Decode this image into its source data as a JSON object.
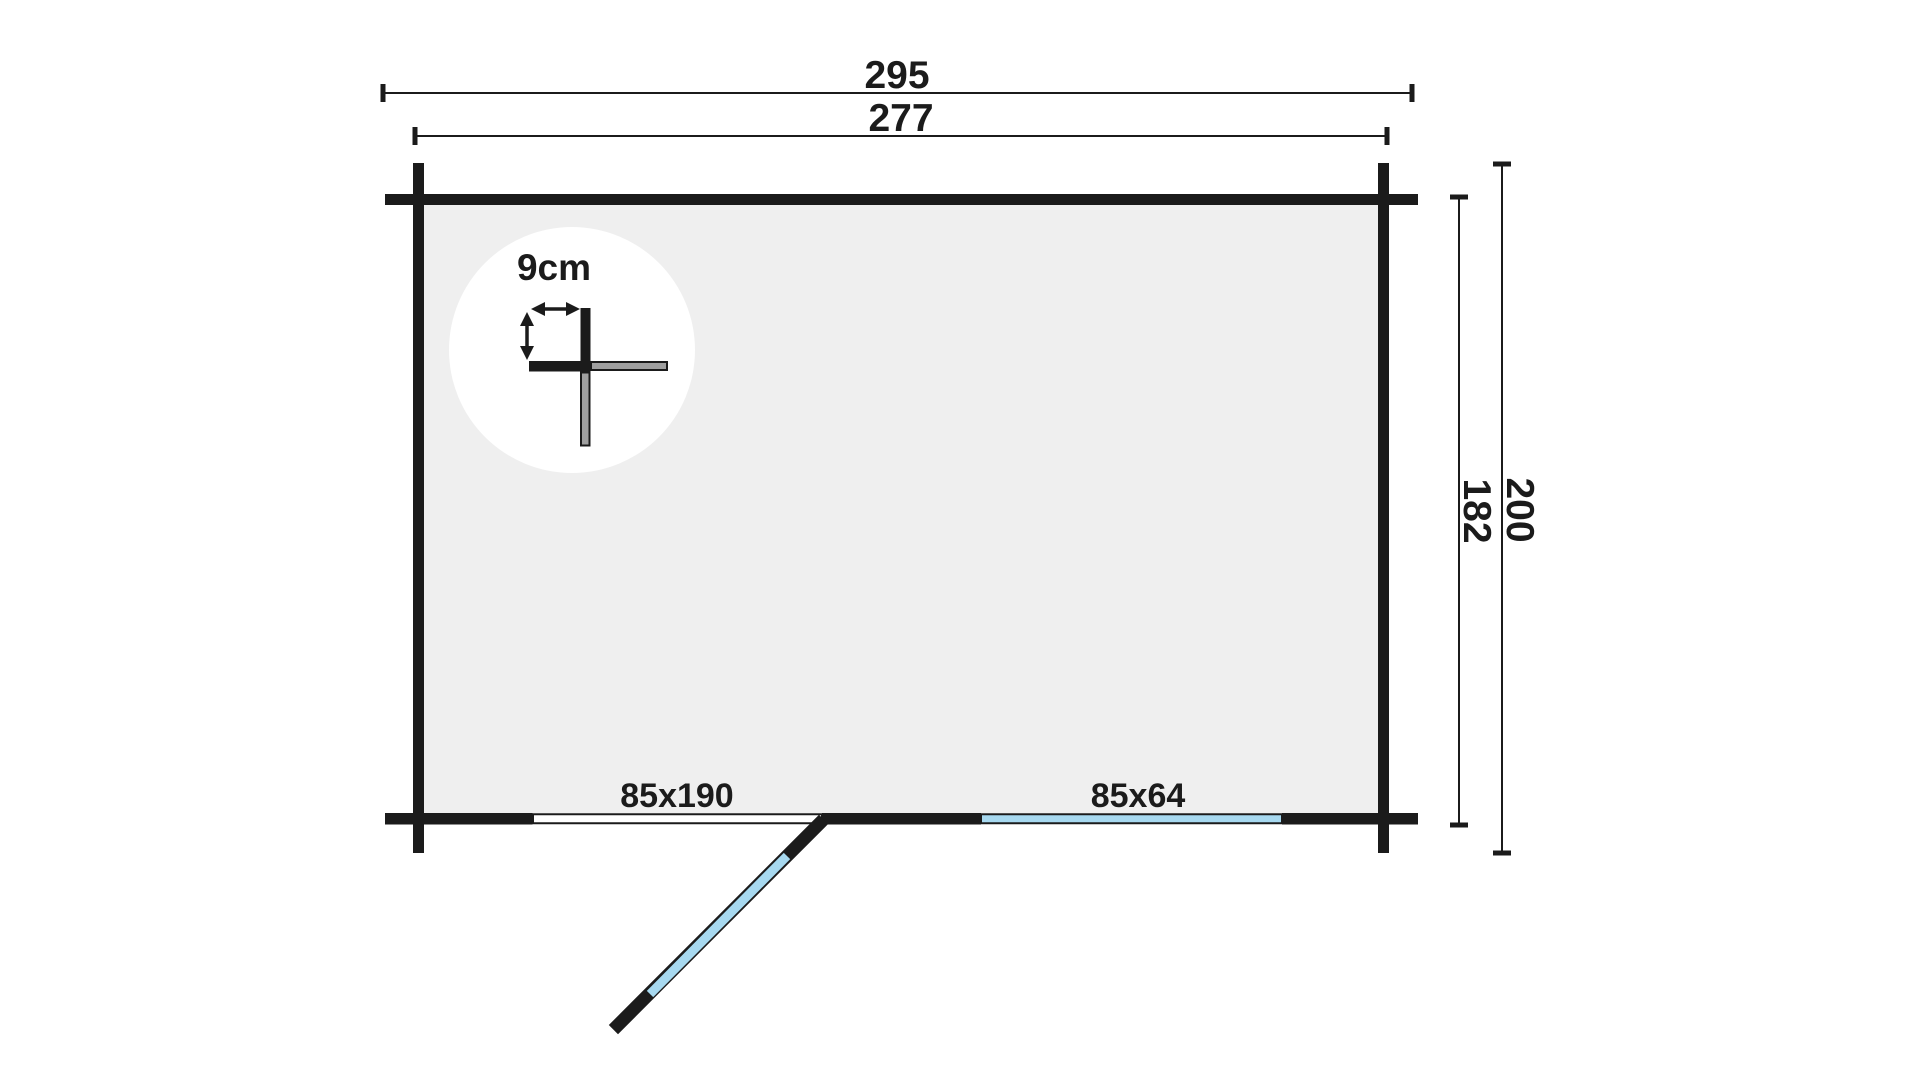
{
  "drawing": {
    "dimensions": {
      "overall_width": "295",
      "wall_to_wall_width": "277",
      "wall_to_wall_depth": "182",
      "overall_depth": "200",
      "wall_thickness": "9cm"
    },
    "openings": {
      "door_label": "85x190",
      "window_label": "85x64"
    }
  },
  "colors": {
    "ink": "#1b1b1b",
    "floor": "#efefef",
    "glass": "#a7d9f0",
    "log": "#a0a0a0",
    "background": "#ffffff"
  }
}
